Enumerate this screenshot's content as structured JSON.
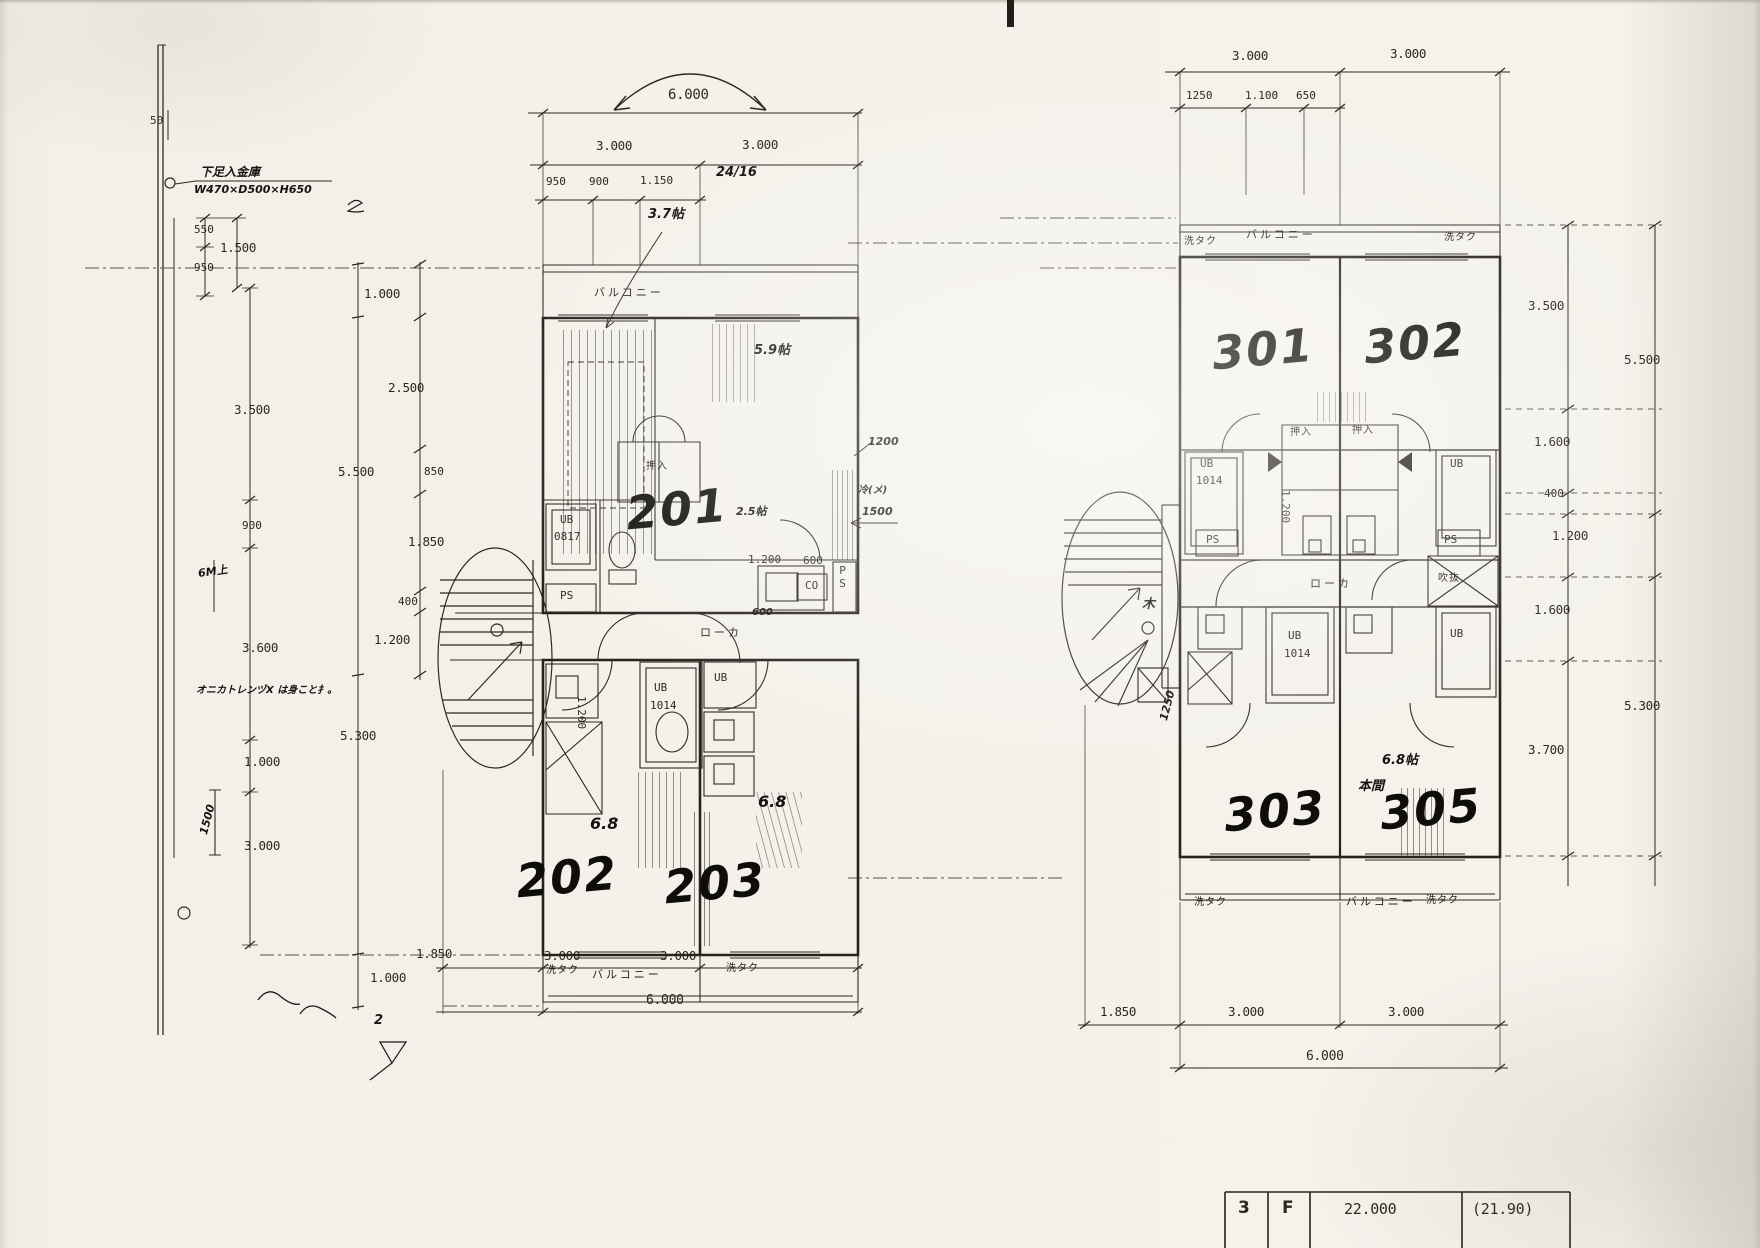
{
  "section": {
    "d50": "50",
    "note_line1": "下足入金庫",
    "note_line2": "W470×D500×H650",
    "d550": "550",
    "d1500": "1.500",
    "d950": "950",
    "d3500": "3.500",
    "d900": "900",
    "hand_6m": "6M上",
    "d3600": "3.600",
    "memo": "オニカトレンヅX は身こと扌。",
    "d1000": "1.000",
    "hand_1500": "1500",
    "d3000": "3.000"
  },
  "mid": {
    "d1000_top": "1.000",
    "d2500": "2.500",
    "d5500": "5.500",
    "d850": "850",
    "d1850": "1.850",
    "d400": "400",
    "d1200": "1.200",
    "d5300": "5.300",
    "d1000_bottom": "1.000",
    "hand_2a": "2",
    "hand_2b": "2"
  },
  "plan2f": {
    "dims_top": {
      "d6000": "6.000",
      "d3000a": "3.000",
      "d3000b": "3.000",
      "d950": "950",
      "d900": "900",
      "d1150": "1.150",
      "hand_2416": "24/16",
      "hand_37": "3.7帖"
    },
    "labels": {
      "balcony_top": "バルコニー",
      "hand_59": "5.9帖",
      "oshiire": "押入",
      "ub_a": "UB",
      "ub_a_size": "0817",
      "hand_25": "2.5帖",
      "hand_1200": "1200",
      "hand_memo": "冷(メ)",
      "hand_1500": "1500",
      "d1200": "1.200",
      "d600": "600",
      "co": "CO",
      "ps_right": "PS",
      "ps_left": "PS",
      "roka": "ローカ",
      "hand_600": "600",
      "ub_b": "UB",
      "ub_b_size": "1014",
      "d1200v": "1.200",
      "ub_c": "UB",
      "hand_68a": "6.8",
      "hand_68b": "6.8",
      "sentaku_l": "洗タク",
      "balcony_bottom": "バルコニー",
      "sentaku_r": "洗タク"
    },
    "units": {
      "u201": "201",
      "u202": "202",
      "u203": "203"
    },
    "dims_bottom": {
      "d1850": "1.850",
      "d3000a": "3.000",
      "d3000b": "3.000",
      "d6000": "6.000"
    }
  },
  "plan3f": {
    "dims_top": {
      "d3000a": "3.000",
      "d3000b": "3.000",
      "d1250": "1250",
      "d1100": "1.100",
      "d650": "650"
    },
    "labels": {
      "sentaku_tl": "洗タク",
      "balcony_top": "バルコニー",
      "sentaku_tr": "洗タク",
      "ub_a": "UB",
      "ub_a_size": "1014",
      "ps_l": "PS",
      "oshiire_a": "押入",
      "oshiire_b": "押入",
      "d1200v": "1.200",
      "ub_b": "UB",
      "ps_r": "PS",
      "fukinuke": "吹抜",
      "roka": "ローカ",
      "hand_ki": "木",
      "hand_1250": "1250",
      "ub_c": "UB",
      "ub_c_size": "1014",
      "ub_d": "UB",
      "hand_68": "6.8帖",
      "hand_honma": "本間",
      "sentaku_bl": "洗タク",
      "balcony_bottom": "バルコニー",
      "sentaku_br": "洗タク"
    },
    "units": {
      "u301": "301",
      "u302": "302",
      "u303": "303",
      "u305": "305"
    },
    "dims_bottom": {
      "d1850": "1.850",
      "d3000a": "3.000",
      "d3000b": "3.000",
      "d6000": "6.000"
    },
    "dims_right": {
      "d3500": "3.500",
      "d1600a": "1.600",
      "d400": "400",
      "d1200": "1.200",
      "d1600b": "1.600",
      "d3700": "3.700",
      "d5500": "5.500",
      "d5300": "5.300"
    }
  },
  "titleblock": {
    "floor": "3",
    "f": "F",
    "area": "22.000",
    "area2": "(21.90)"
  }
}
